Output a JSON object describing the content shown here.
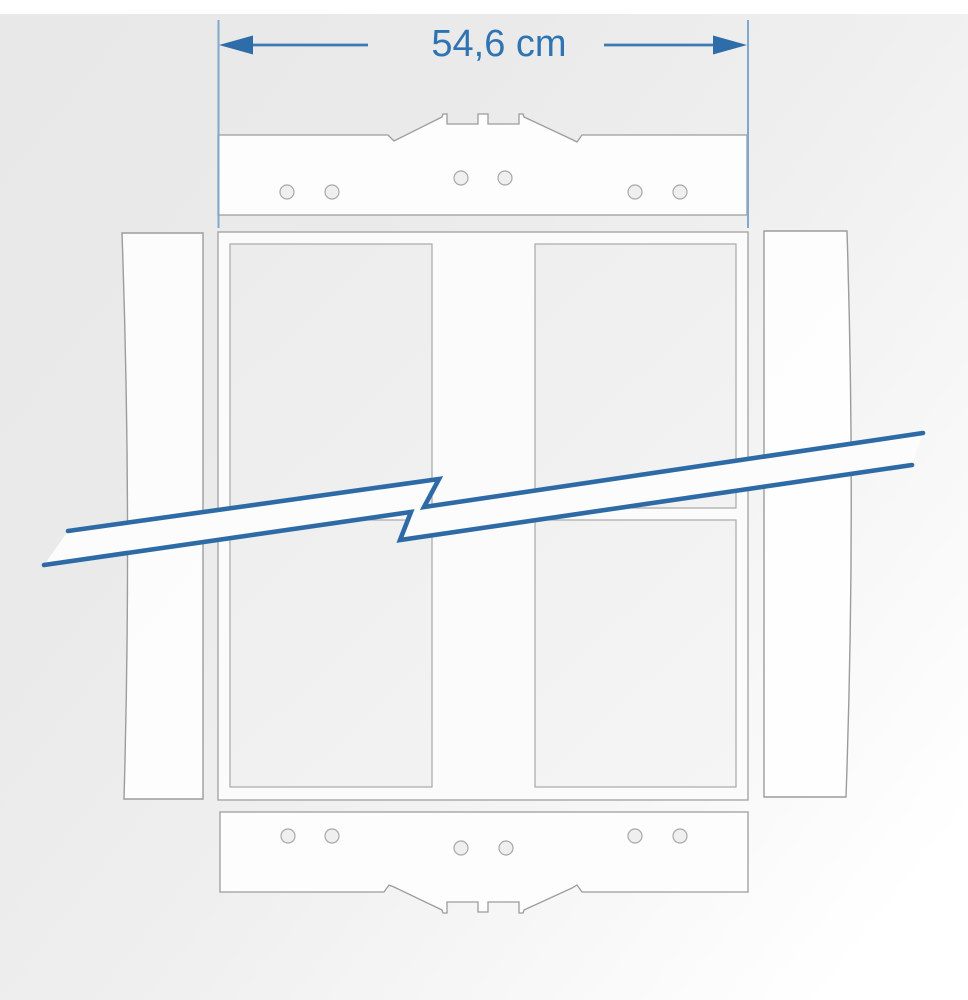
{
  "diagram": {
    "title": "crate-frame-width-dimension-drawing",
    "dimension": {
      "label": "54,6 cm",
      "value": "54,6",
      "unit": "cm"
    },
    "colors": {
      "accent_blue": "#2e6da8",
      "dim_line_blue": "#3c7ab1",
      "extension_line_blue": "#7fa8cc",
      "break_line_blue": "#2e6ba6",
      "outline_gray": "#9c9c9c",
      "board_fill": "#fdfdfd",
      "opening_fill": "#efefef"
    },
    "parts": {
      "top_board": "notched cross board with 6 screw holes",
      "bottom_board": "notched cross board with 6 screw holes",
      "left_board": "left side slat",
      "right_board": "right side slat",
      "frame": "inner frame with four openings and center divider",
      "break_symbol": "zigzag break line indicating shortened view"
    }
  }
}
